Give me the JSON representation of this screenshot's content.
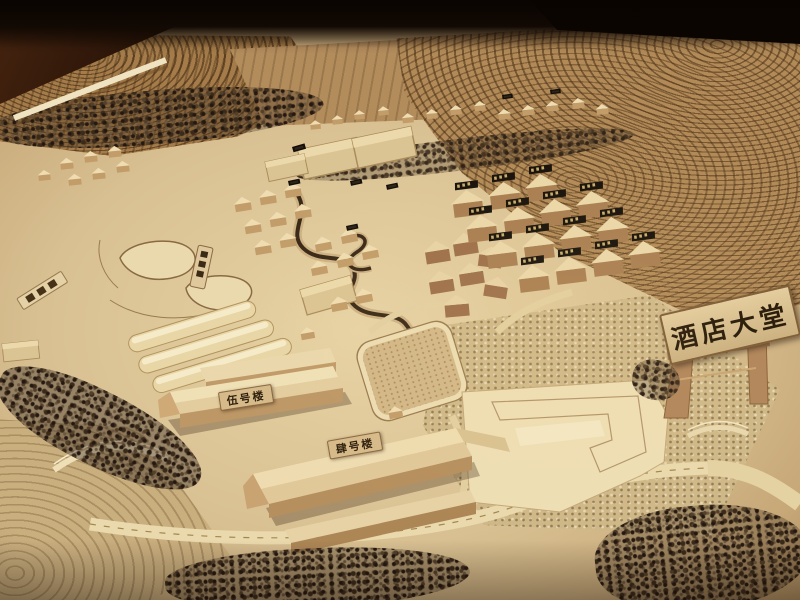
{
  "signs": {
    "hotel_lobby": "酒店大堂",
    "building_no_5": "伍号楼",
    "building_no_4": "肆号楼"
  },
  "palette": {
    "terrain_base": "#dcc394",
    "terraced_hill": "#b18a57",
    "contour_line": "#5f3d1d",
    "stream_water": "#392917",
    "wood_building_light": "#eedcae",
    "wood_building_shadow": "#b8915f",
    "brick_building_wall": "#9c6f4c",
    "tree_foliage": "#3a2a1a",
    "sign_board": "#dcc497",
    "sign_text": "#241808",
    "name_plaque_dark": "#15100a",
    "room_background": "#120a04"
  }
}
